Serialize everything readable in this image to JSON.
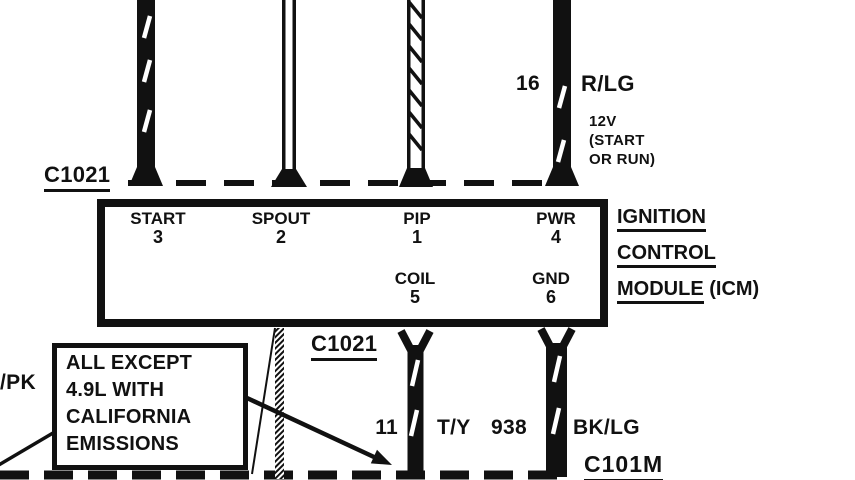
{
  "colors": {
    "ink": "#111111",
    "bg": "#ffffff"
  },
  "connectors": {
    "top": "C1021",
    "mid": "C1021",
    "bottom": "C101M"
  },
  "icm": {
    "pins_top": [
      {
        "name": "START",
        "number": "3"
      },
      {
        "name": "SPOUT",
        "number": "2"
      },
      {
        "name": "PIP",
        "number": "1"
      },
      {
        "name": "PWR",
        "number": "4"
      }
    ],
    "pins_bottom": [
      {
        "name": "COIL",
        "number": "5"
      },
      {
        "name": "GND",
        "number": "6"
      }
    ],
    "title": {
      "line1": "IGNITION",
      "line2": "CONTROL",
      "line3_underlined": "MODULE",
      "line3_rest": " (ICM)"
    }
  },
  "wire_labels": {
    "pwr": {
      "circuit": "16",
      "color": "R/LG",
      "note": "12V\n(START\nOR RUN)"
    },
    "coil": {
      "circuit": "11",
      "color": "T/Y"
    },
    "gnd": {
      "circuit": "938",
      "color": "BK/LG"
    },
    "left_partial": "/PK"
  },
  "callout": {
    "text": "ALL EXCEPT\n4.9L WITH\nCALIFORNIA\nEMISSIONS"
  }
}
